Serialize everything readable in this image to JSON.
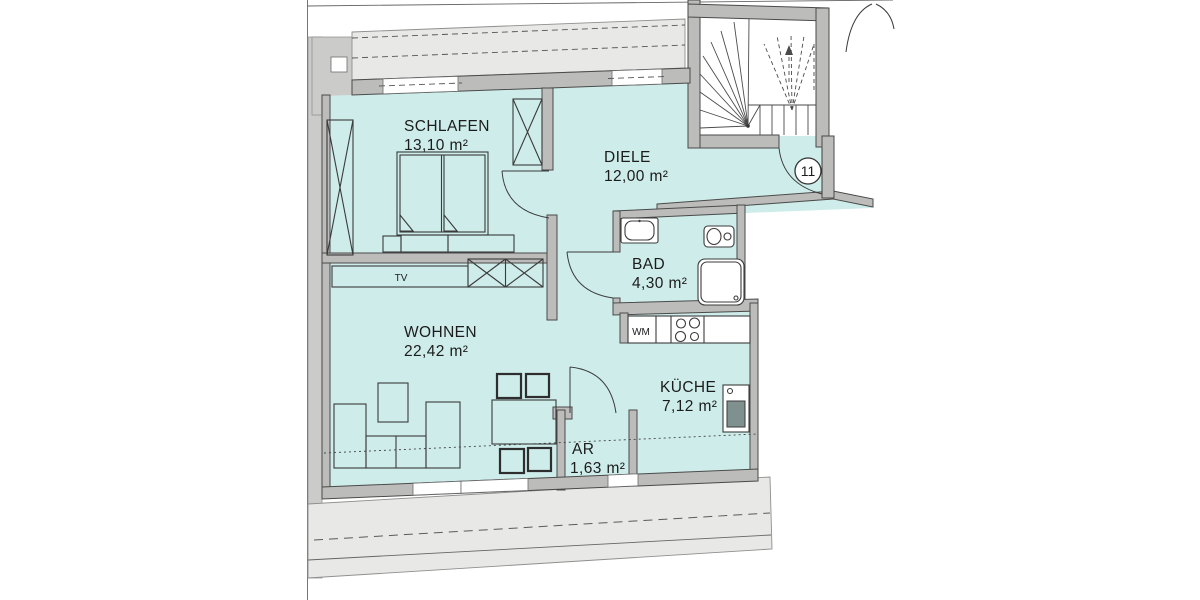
{
  "plan": {
    "title": "apartment-floor-plan",
    "unit_number": "11",
    "rooms": [
      {
        "name": "SCHLAFEN",
        "area": "13,10 m²"
      },
      {
        "name": "DIELE",
        "area": "12,00 m²"
      },
      {
        "name": "BAD",
        "area": "4,30 m²"
      },
      {
        "name": "WOHNEN",
        "area": "22,42 m²"
      },
      {
        "name": "KÜCHE",
        "area": "7,12 m²"
      },
      {
        "name": "AR",
        "area": "1,63 m²"
      }
    ],
    "labels": {
      "tv": "TV",
      "wm": "WM"
    },
    "colors": {
      "room_fill": "#cdecea",
      "wall_fill": "#bcbcba",
      "wall_stroke": "#4a4a4a",
      "roof_fill": "#e8e8e6",
      "line_dark": "#3b3b3b"
    }
  }
}
